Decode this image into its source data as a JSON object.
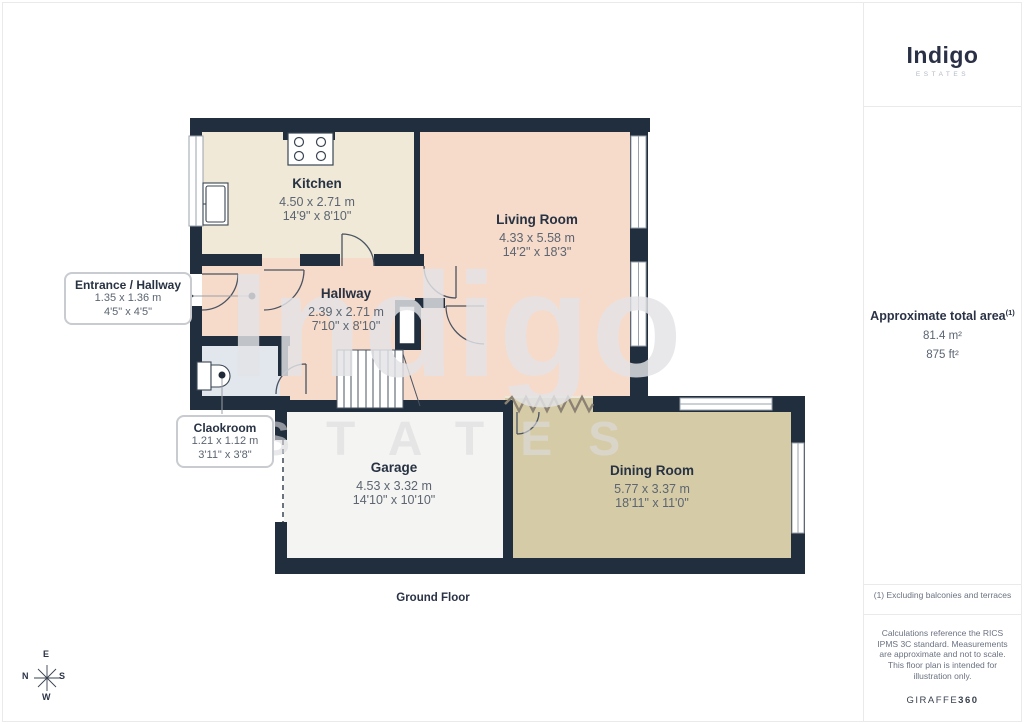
{
  "branding": {
    "logo_text": "Indigo",
    "logo_subtext": "ESTATES",
    "watermark": "Indigo",
    "watermark_sub": "ESTATES"
  },
  "sidebar": {
    "total_area_label": "Approximate total area",
    "total_area_superscript": "(1)",
    "area_m2": "81.4 m²",
    "area_ft2": "875 ft²",
    "footnote": "(1) Excluding balconies and terraces",
    "disclaimer": "Calculations reference the RICS IPMS 3C standard. Measurements are approximate and not to scale. This floor plan is intended for illustration only.",
    "provider_name": "GIRAFFE",
    "provider_number": "360"
  },
  "floor_label": "Ground Floor",
  "compass": {
    "north": "N",
    "east": "E",
    "south": "S",
    "west": "W"
  },
  "rooms": [
    {
      "name": "Kitchen",
      "metric": "4.50 x 2.71 m",
      "imperial": "14'9\" x 8'10\""
    },
    {
      "name": "Living Room",
      "metric": "4.33 x 5.58 m",
      "imperial": "14'2\" x 18'3\""
    },
    {
      "name": "Hallway",
      "metric": "2.39 x 2.71 m",
      "imperial": "7'10\" x 8'10\""
    },
    {
      "name": "Garage",
      "metric": "4.53 x 3.32 m",
      "imperial": "14'10\" x 10'10\""
    },
    {
      "name": "Dining Room",
      "metric": "5.77 x 3.37 m",
      "imperial": "18'11\" x 11'0\""
    }
  ],
  "callouts": [
    {
      "name": "Entrance / Hallway",
      "metric": "1.35 x 1.36 m",
      "imperial": "4'5\" x 4'5\""
    },
    {
      "name": "Claokroom",
      "metric": "1.21 x 1.12 m",
      "imperial": "3'11\" x 3'8\""
    }
  ],
  "colors": {
    "wall": "#212e3d",
    "kitchen_floor": "#f0e9d8",
    "living_floor": "#f6daca",
    "dining_floor": "#d6cba7",
    "garage_floor": "#f4f4f2",
    "cloakroom_floor": "#e2e6ed",
    "logo_navy": "#2a3147"
  }
}
